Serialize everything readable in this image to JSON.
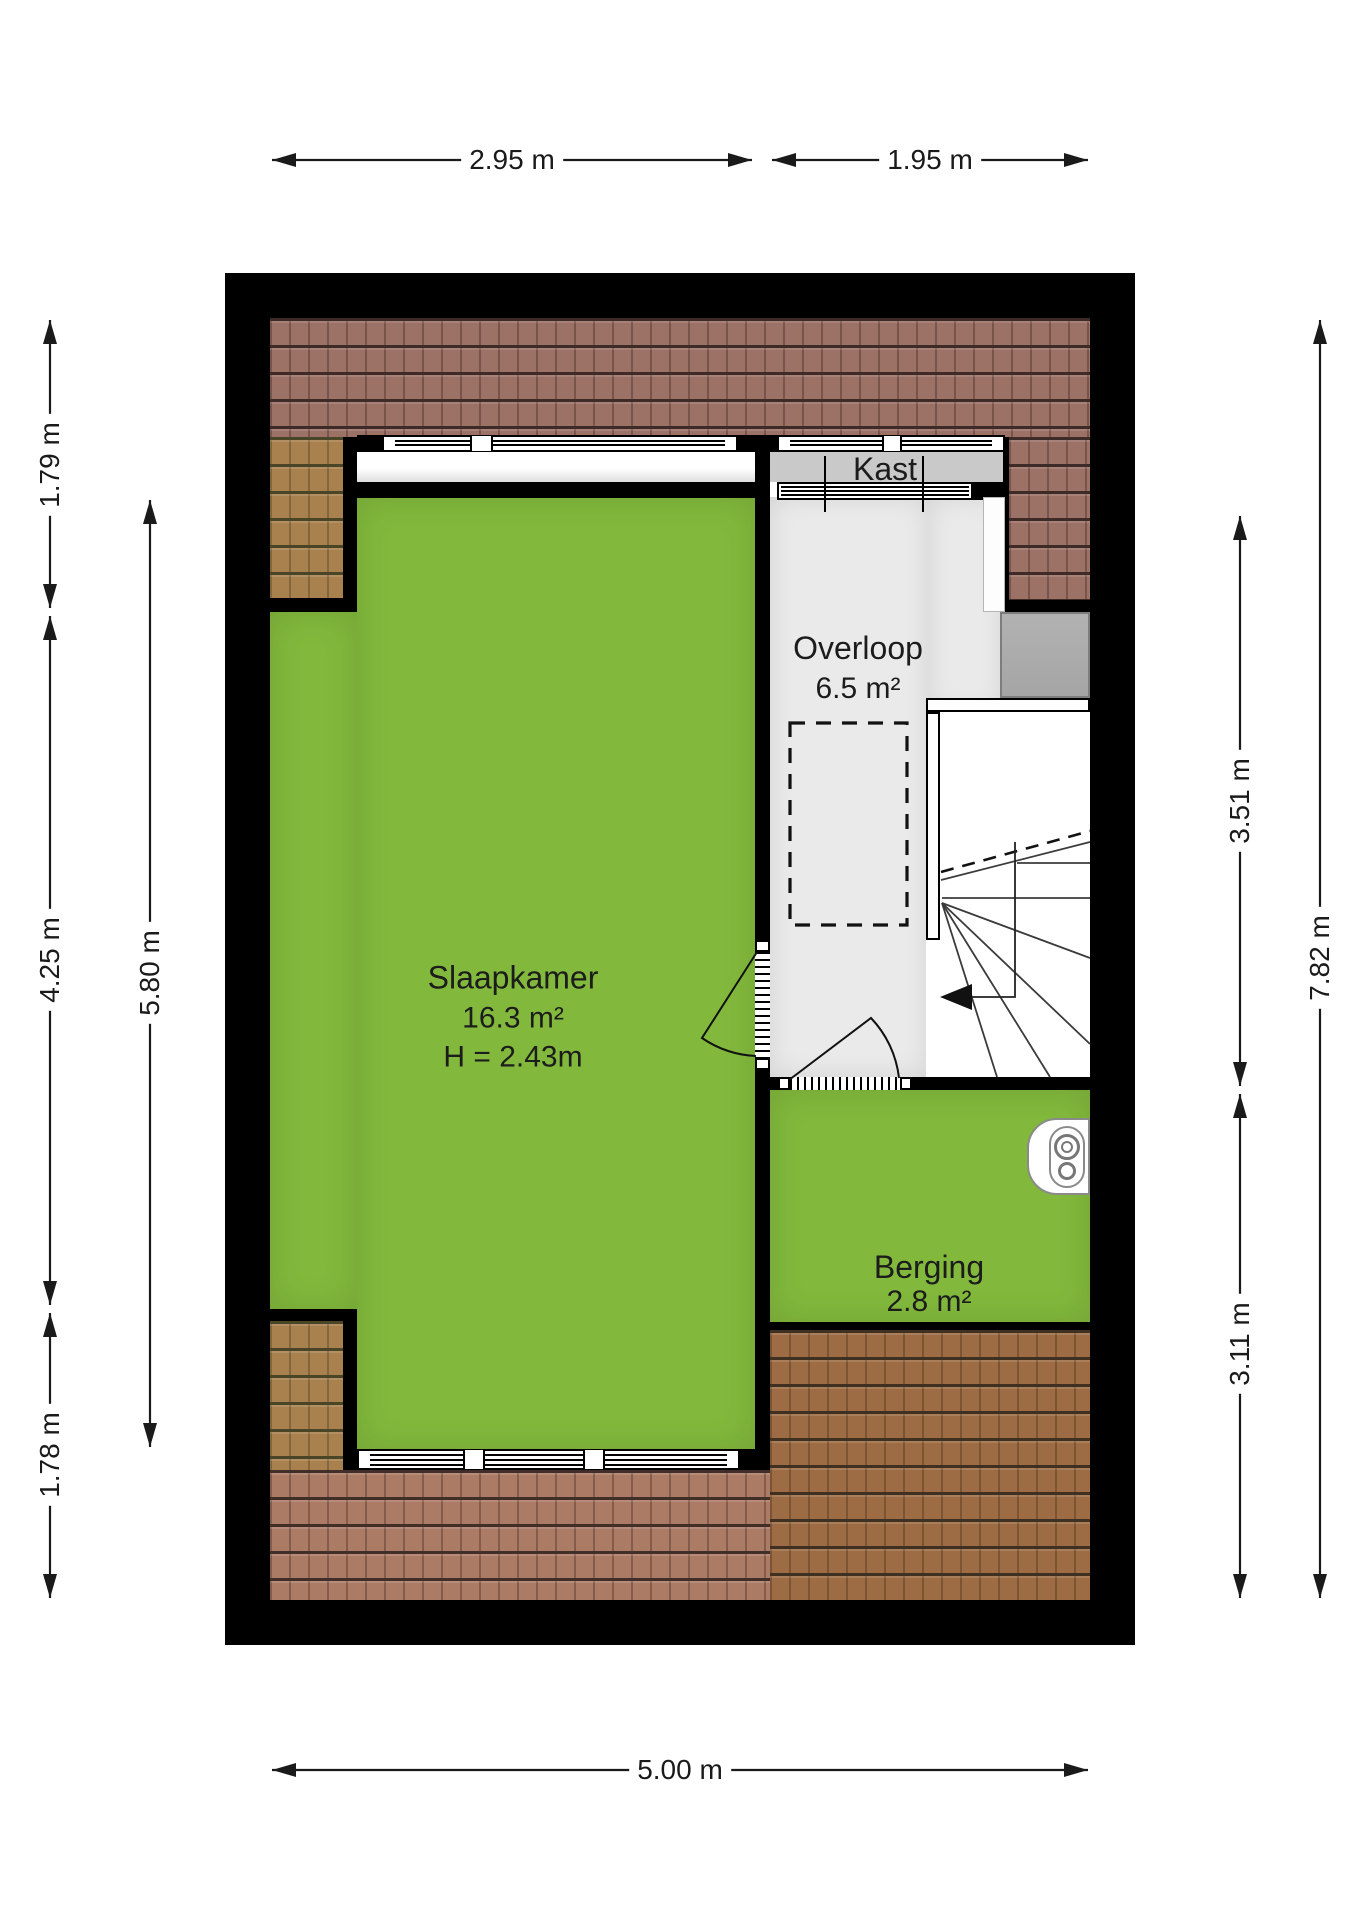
{
  "rooms": {
    "slaapkamer": {
      "name": "Slaapkamer",
      "area": "16.3 m²",
      "ceiling_height": "H = 2.43m"
    },
    "overloop": {
      "name": "Overloop",
      "area": "6.5 m²"
    },
    "berging": {
      "name": "Berging",
      "area": "2.8 m²"
    },
    "kast": {
      "name": "Kast"
    }
  },
  "dimensions": {
    "top_left": "2.95 m",
    "top_right": "1.95 m",
    "left_outer_top": "1.79 m",
    "left_outer_middle": "4.25 m",
    "left_outer_bottom": "1.78 m",
    "left_inner": "5.80 m",
    "right_inner_top": "3.51 m",
    "right_inner_bottom": "3.11 m",
    "right_outer": "7.82 m",
    "bottom": "5.00 m"
  },
  "icons": {
    "boiler": "boiler-icon",
    "stairs_direction": "arrow-left-icon"
  },
  "colors": {
    "wall": "#000000",
    "room_green": "#82b93c",
    "floor_gray": "#eaeaea",
    "kast_gray": "#c9c9c9",
    "chimney_gray": "#a5a5a5",
    "roof_red": "#9c7166",
    "roof_red_line": "#3e2b28",
    "roof_tan": "#a8814f",
    "roof_tan_line": "#4a4526",
    "roof_salmon": "#ac7b66",
    "roof_salmon_line": "#422e28",
    "roof_brown": "#9d6c44",
    "roof_brown_line": "#3f3021",
    "text": "#1a1a1a"
  }
}
